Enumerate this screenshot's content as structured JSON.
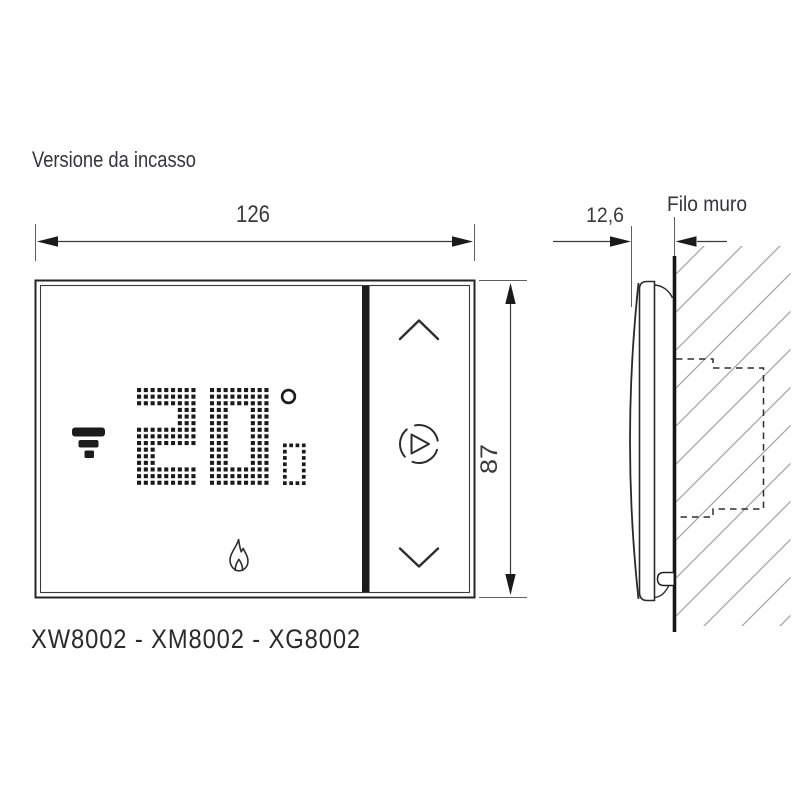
{
  "title": "Versione da incasso",
  "product_codes": "XW8002 - XM8002 - XG8002",
  "front_view": {
    "width_dim": "126",
    "height_dim": "87",
    "display": {
      "temperature": "20",
      "decimal": "0",
      "unit": "degree-symbol",
      "wifi_icon": "wifi-signal",
      "flame_icon": "heating-flame"
    },
    "buttons": {
      "up": "chevron-up",
      "boost": "play-boost",
      "down": "chevron-down"
    }
  },
  "side_view": {
    "depth_dim": "12,6",
    "wall_label": "Filo muro"
  },
  "colors": {
    "line": "#2a2a2a",
    "dim": "#3a3a3e",
    "arrow": "#1a1a1a",
    "extension": "#5f5f63",
    "hatch": "#a3a3a3",
    "dot": "#1b1b1b",
    "bar": "#1c1c1c"
  }
}
